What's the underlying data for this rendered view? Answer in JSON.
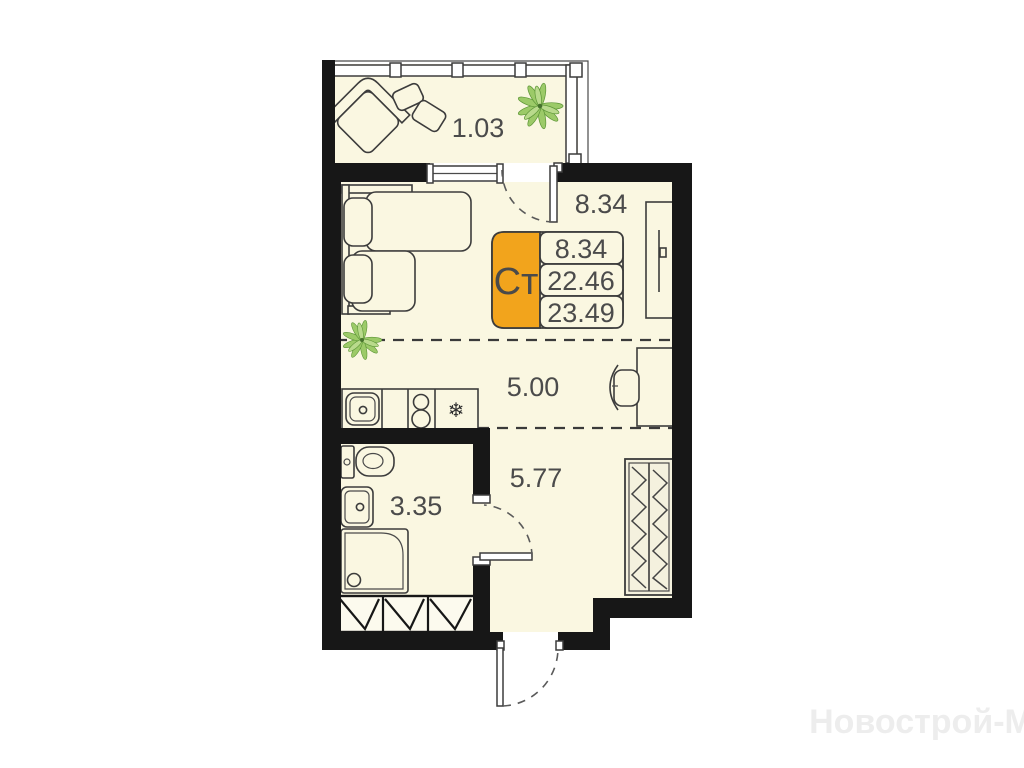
{
  "unit_card": {
    "type_label": "Ст",
    "rows": [
      "8.34",
      "22.46",
      "23.49"
    ],
    "accent_color": "#F2A41C"
  },
  "room_labels": {
    "balcony": "1.03",
    "room": "8.34",
    "kitchen_zone": "5.00",
    "bathroom": "3.35",
    "hallway": "5.77"
  },
  "icons": {
    "fridge_snowflake": "❄",
    "plant": "plant-icon"
  },
  "colors": {
    "floor": "#FAF7E1",
    "wall": "#171717",
    "accent": "#F2A41C",
    "outline": "#3C3C3C",
    "label_text": "#4B4B4B",
    "plant_fill": "#9CCA68",
    "watermark": "#EDEDED"
  },
  "watermark": "Новострой-М"
}
